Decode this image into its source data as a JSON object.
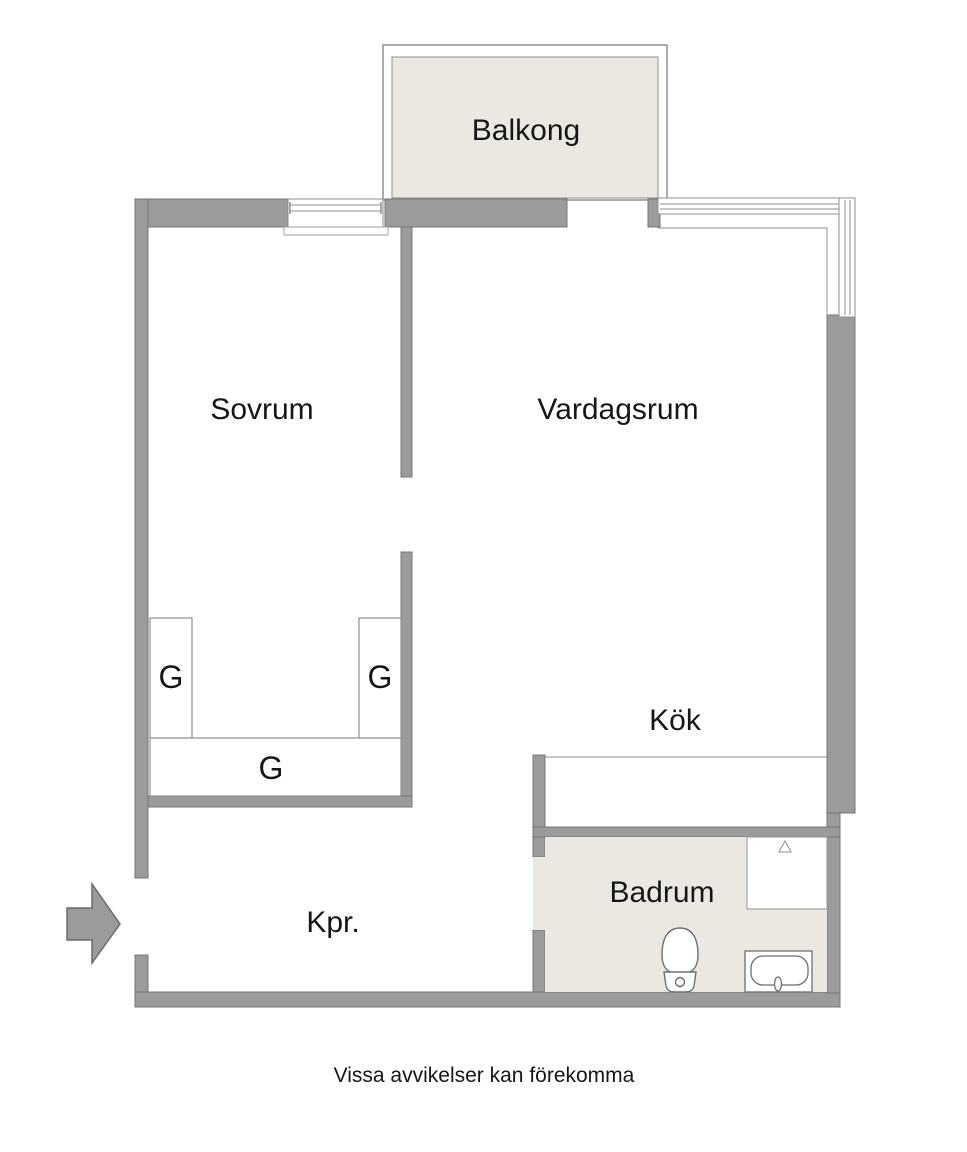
{
  "plan": {
    "rooms": {
      "balcony": {
        "label": "Balkong"
      },
      "bedroom": {
        "label": "Sovrum"
      },
      "living_room": {
        "label": "Vardagsrum"
      },
      "kitchen": {
        "label": "Kök"
      },
      "bathroom": {
        "label": "Badrum"
      },
      "hallway": {
        "label": "Kpr."
      }
    },
    "closets": {
      "left": {
        "label": "G"
      },
      "right": {
        "label": "G"
      },
      "bottom": {
        "label": "G"
      }
    },
    "fixtures": {
      "toilet": "toilet-icon",
      "washbasin": "washbasin-icon",
      "shower": "shower-icon",
      "entry_arrow": "entry-arrow-icon"
    },
    "disclaimer": "Vissa avvikelser kan förekomma",
    "colors": {
      "wall_fill": "#9b9b9b",
      "wall_outline": "#757575",
      "floor_accent": "#ebe8e2",
      "thin_line": "#8f8f8f",
      "fixture_outline": "#6e6e6e",
      "text": "#161616",
      "background": "#ffffff"
    }
  }
}
